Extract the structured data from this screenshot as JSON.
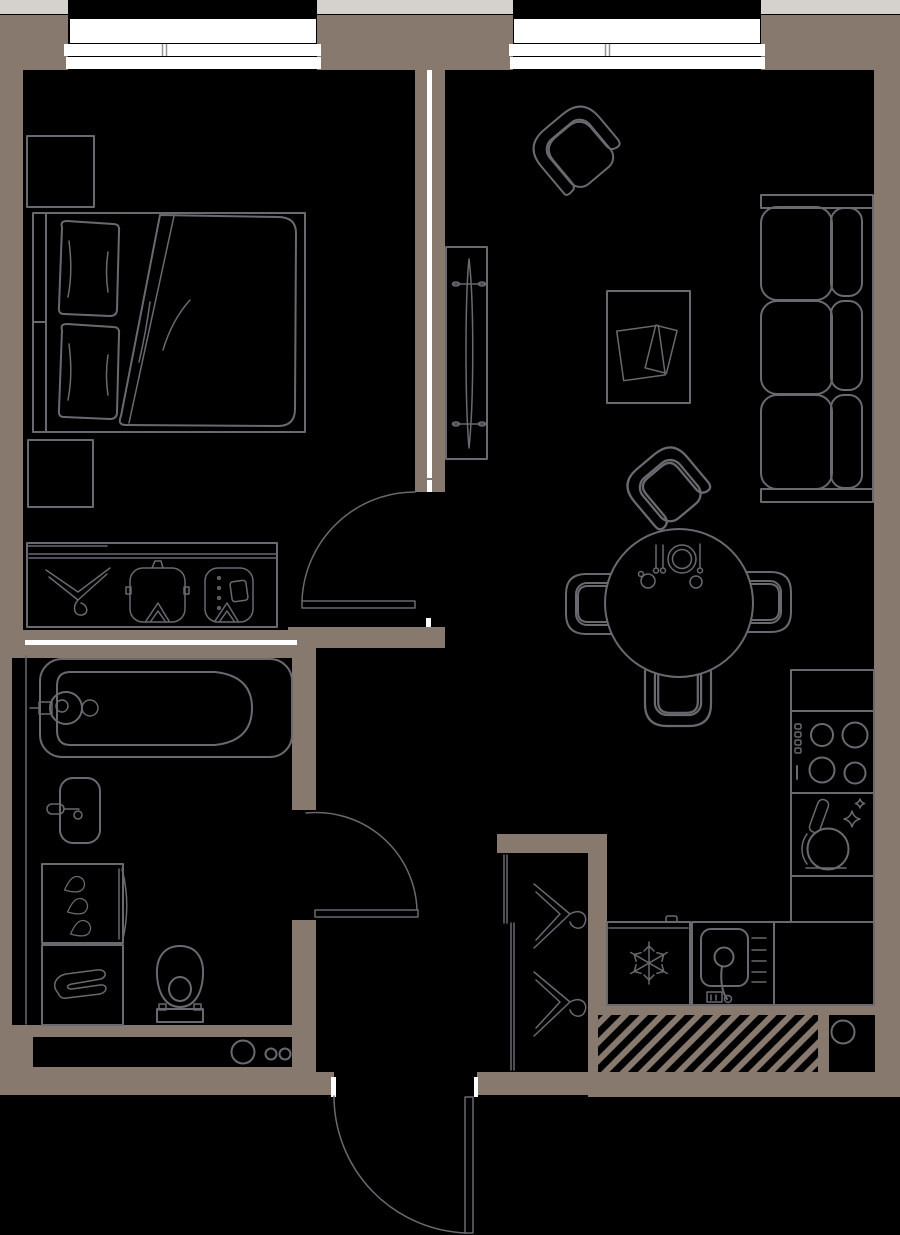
{
  "meta": {
    "title": "One-bedroom apartment floor plan",
    "drawing_type": "architectural top-view floor plan",
    "canvas": {
      "width_px": 900,
      "height_px": 1235
    }
  },
  "palette": {
    "background": "#000000",
    "wall": "#87796E",
    "line": "#6A6970",
    "accent_white": "#FFFFFF",
    "exterior_strip": "#D5D2CE"
  },
  "features": {
    "windows_count": 2,
    "window_locations": [
      "top wall left (bedroom)",
      "top wall right (living room)"
    ],
    "doors": [
      "bedroom swing door",
      "bathroom swing door",
      "entrance swing door (opens outward at bottom)"
    ],
    "service_shafts": [
      "hatched ventilation duct in bottom-right wall",
      "round riser in square niche bottom-right",
      "pipe niche with 3 riser circles below bathroom"
    ]
  },
  "rooms": [
    {
      "name": "bedroom",
      "position": "top-left",
      "furniture": [
        "double bed with duvet and 2 pillows",
        "headboard",
        "dresser (top-left)",
        "nightstand (below bed)",
        "open wardrobe rail with 3 hangers: empty hanger, shirt, coat"
      ]
    },
    {
      "name": "living-room",
      "position": "top-right",
      "furniture": [
        "rotated armchair",
        "coffee table with magazine",
        "tall TV / media panel on partition",
        "3-seat sofa on right wall",
        "round dining table",
        "4 dining chairs",
        "table place setting: plate, 3 utensils, 2 cups"
      ]
    },
    {
      "name": "kitchen",
      "position": "right-bottom L-shaped counter",
      "furniture": [
        "empty counter section",
        "cooktop with 4 burners and 4 knobs",
        "cabinet with pan and sparkles",
        "fridge with snowflake symbol",
        "sink unit with faucet and drainer"
      ]
    },
    {
      "name": "bathroom",
      "position": "bottom-left",
      "furniture": [
        "bathtub with faucet and drain",
        "wash basin with tap",
        "cabinet with 3 water drops",
        "shelf with folded towel",
        "toilet"
      ]
    },
    {
      "name": "hallway",
      "position": "bottom-center",
      "furniture": [
        "sliding-door closet with 2 hangers",
        "entrance door"
      ]
    }
  ],
  "counts": {
    "sofa_seats": 3,
    "cooktop_burners": 4,
    "dining_chairs": 4,
    "wardrobe_hangers": 3,
    "closet_hangers": 2,
    "riser_circles_bathroom_niche": 3,
    "bathroom_drops_icon": 3
  }
}
